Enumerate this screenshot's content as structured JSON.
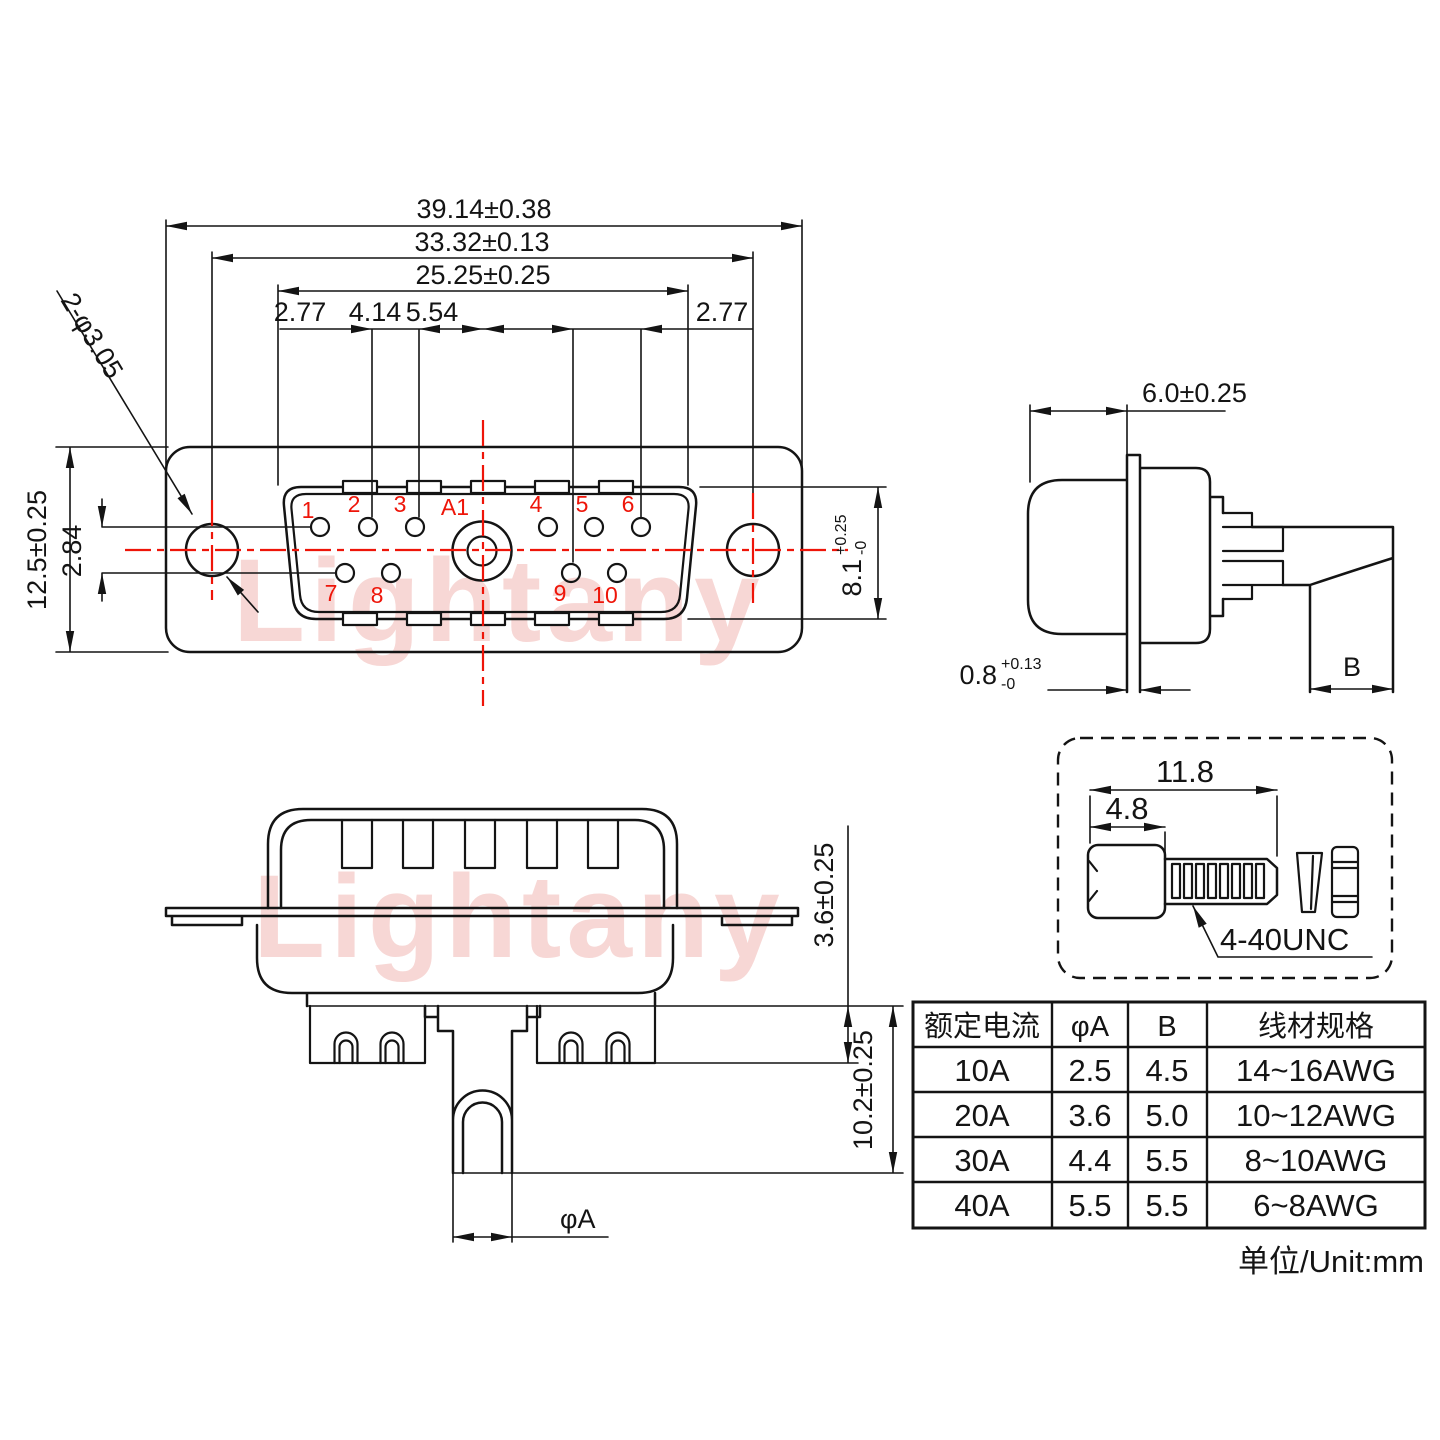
{
  "watermark": {
    "text": "Lightany"
  },
  "unit_note": "单位/Unit:mm",
  "colors": {
    "line": "#141414",
    "accent_red": "#ee1509",
    "watermark_pink": "#f7d7d5",
    "background": "#ffffff"
  },
  "front_view": {
    "dims": {
      "overall": "39.14±0.38",
      "hole_cc": "33.32±0.13",
      "shell_w": "25.25±0.25",
      "pitch_a": "2.77",
      "pitch_b": "4.14",
      "pitch_c": "5.54",
      "pitch_d": "2.77",
      "flange_h": "12.5±0.25",
      "row_gap": "2.84",
      "shell_h": "8.1",
      "shell_h_up": "+0.25",
      "shell_h_dn": "-0",
      "mount_holes": "2-φ3.05"
    },
    "pins": [
      "1",
      "2",
      "3",
      "A1",
      "4",
      "5",
      "6",
      "7",
      "8",
      "9",
      "10"
    ]
  },
  "side_view": {
    "dims": {
      "depth": "6.0±0.25",
      "flange_t": "0.8",
      "flange_t_up": "+0.13",
      "flange_t_dn": "-0",
      "wire_w": "B"
    }
  },
  "bottom_view": {
    "dims": {
      "collar_h": "3.6±0.25",
      "cup_len": "10.2±0.25",
      "cup_dia": "φA"
    }
  },
  "screw_detail": {
    "total_len": "11.8",
    "head_len": "4.8",
    "thread": "4-40UNC"
  },
  "table": {
    "headers": [
      "额定电流",
      "φA",
      "B",
      "线材规格"
    ],
    "rows": [
      [
        "10A",
        "2.5",
        "4.5",
        "14~16AWG"
      ],
      [
        "20A",
        "3.6",
        "5.0",
        "10~12AWG"
      ],
      [
        "30A",
        "4.4",
        "5.5",
        "8~10AWG"
      ],
      [
        "40A",
        "5.5",
        "5.5",
        "6~8AWG"
      ]
    ]
  }
}
